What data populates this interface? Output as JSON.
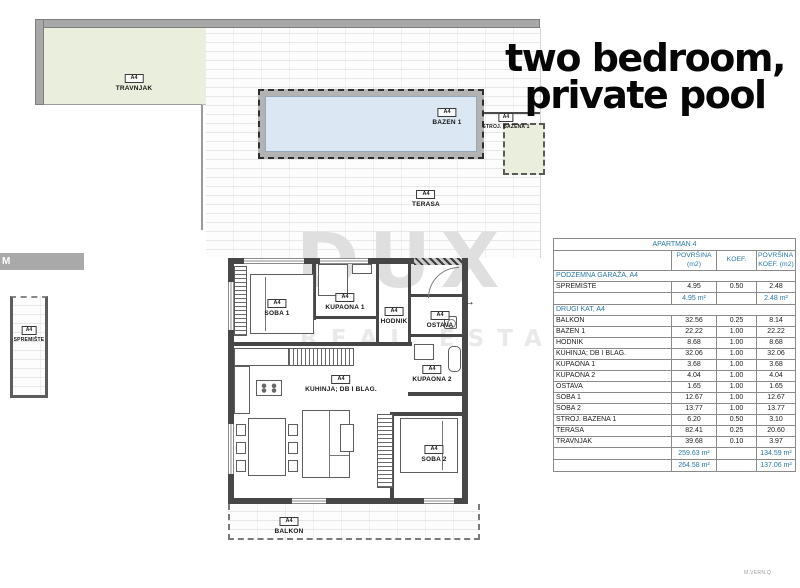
{
  "title": {
    "line1": "two bedroom,",
    "line2": "private pool"
  },
  "watermark": {
    "primary": "DUX",
    "secondary": "REAL ESTATE"
  },
  "side_band_label": "M",
  "corner_note": "M.VERN.Q",
  "icons": {
    "entry_arrow": "→"
  },
  "colors": {
    "table_blue": "#2878a8",
    "lawn_green": "#e9efdc",
    "pool_blue": "#dbe8f4",
    "wall_gray": "#474747"
  },
  "rooms": [
    {
      "tag": "A4",
      "name": "TRAVNJAK"
    },
    {
      "tag": "A4",
      "name": "BAZEN 1"
    },
    {
      "tag": "A4",
      "name": "STROJ. BAZENA 1"
    },
    {
      "tag": "A4",
      "name": "TERASA"
    },
    {
      "tag": "A4",
      "name": "SPREMIŠTE"
    },
    {
      "tag": "A4",
      "name": "SOBA 1"
    },
    {
      "tag": "A4",
      "name": "KUPAONA 1"
    },
    {
      "tag": "A4",
      "name": "HODNIK"
    },
    {
      "tag": "A4",
      "name": "OSTAVA"
    },
    {
      "tag": "A4",
      "name": "KUPAONA 2"
    },
    {
      "tag": "A4",
      "name": "KUHINJA; DB I BLAG."
    },
    {
      "tag": "A4",
      "name": "SOBA 2"
    },
    {
      "tag": "A4",
      "name": "BALKON"
    }
  ],
  "table": {
    "title": "APARTMAN 4",
    "headers": {
      "c1a": "POVRŠINA",
      "c1b": "(m2)",
      "c2": "KOEF.",
      "c3a": "POVRŠINA S",
      "c3b": "KOEF. (m2)"
    },
    "section1": {
      "header": "PODZEMNA GARAŽA, A4",
      "rows": [
        [
          "SPREMIŠTE",
          "4.95",
          "0.50",
          "2.48"
        ]
      ],
      "subtotal": {
        "a": "4.95 m²",
        "s": "2.48 m²"
      }
    },
    "section2": {
      "header": "DRUGI KAT, A4",
      "rows": [
        [
          "BALKON",
          "32.56",
          "0.25",
          "8.14"
        ],
        [
          "BAZEN 1",
          "22.22",
          "1.00",
          "22.22"
        ],
        [
          "HODNIK",
          "8.68",
          "1.00",
          "8.68"
        ],
        [
          "KUHINJA; DB I BLAG.",
          "32.06",
          "1.00",
          "32.06"
        ],
        [
          "KUPAONA 1",
          "3.68",
          "1.00",
          "3.68"
        ],
        [
          "KUPAONA 2",
          "4.04",
          "1.00",
          "4.04"
        ],
        [
          "OSTAVA",
          "1.65",
          "1.00",
          "1.65"
        ],
        [
          "SOBA 1",
          "12.67",
          "1.00",
          "12.67"
        ],
        [
          "SOBA 2",
          "13.77",
          "1.00",
          "13.77"
        ],
        [
          "STROJ. BAZENA 1",
          "6.20",
          "0.50",
          "3.10"
        ],
        [
          "TERASA",
          "82.41",
          "0.25",
          "20.60"
        ],
        [
          "TRAVNJAK",
          "39.68",
          "0.10",
          "3.97"
        ]
      ],
      "subtotal": {
        "a": "259.63 m²",
        "s": "134.59 m²"
      }
    },
    "total": {
      "a": "264.58 m²",
      "s": "137.06 m²"
    }
  }
}
